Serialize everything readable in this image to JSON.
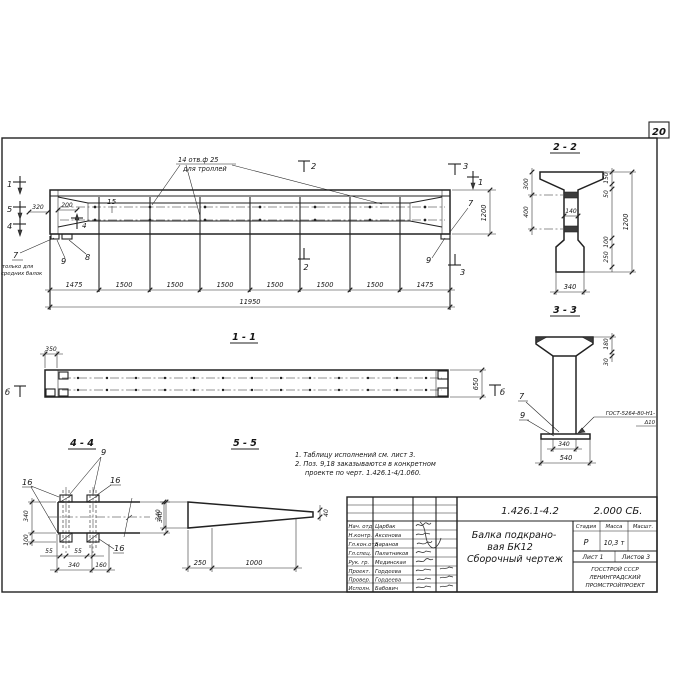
{
  "sheet": {
    "number": "20"
  },
  "elevation": {
    "hole_note_line1": "14 отв.ф 25",
    "hole_note_line2": "для троллей",
    "only_note_line1": "только для",
    "only_note_line2": "средних балок",
    "pos7": "7",
    "pos8": "8",
    "pos9": "9",
    "pos15": "15",
    "pos7_right": "7",
    "pos9_right": "9",
    "cut1_left": "1",
    "cut5_left": "5",
    "cut4_left": "4",
    "cut4_bottom": "4",
    "cut2_top": "2",
    "cut2_bottom": "2",
    "cut3_top": "3",
    "cut3_bottom": "3",
    "cut1_right": "1",
    "dim320": "320",
    "dim200": "200",
    "dim1200": "1200",
    "segments": [
      "1475",
      "1500",
      "1500",
      "1500",
      "1500",
      "1500",
      "1500",
      "1475"
    ],
    "total": "11950"
  },
  "section22": {
    "title": "2 - 2",
    "dim300": "300",
    "dim400": "400",
    "dim140": "140",
    "dim150": "150",
    "dim50": "50",
    "dim1200": "1200",
    "dim100": "100",
    "dim250": "250",
    "dim340": "340"
  },
  "section33": {
    "title": "3 - 3",
    "dim180": "180",
    "dim30": "30",
    "dim340": "340",
    "dim540": "540",
    "pos7": "7",
    "pos9": "9",
    "weld_line1": "ГОСТ-5264-80-Н1-",
    "weld_line2": "Δ10"
  },
  "section11": {
    "title": "1 - 1",
    "dim350": "350",
    "dim650": "650",
    "mark_left": "б",
    "mark_right": "б"
  },
  "section44": {
    "title": "4 - 4",
    "pos9": "9",
    "pos16_left": "16",
    "pos16_right": "16",
    "pos16_bottom": "16",
    "dim340_left": "340",
    "dim100": "100",
    "dim340_right": "340",
    "dim55_a": "55",
    "dim55_b": "55",
    "dim340_bottom": "340",
    "dim160": "160"
  },
  "section55": {
    "title": "5 - 5",
    "dim340": "340",
    "dim40": "40",
    "dim250": "250",
    "dim1000": "1000"
  },
  "notes": {
    "line1": "1. Таблицу исполнений  см. лист 3.",
    "line2": "2. Поз. 9,18 заказываются в конкретном",
    "line3": "проекте по черт. 1.426.1-4/1.060."
  },
  "titleblock": {
    "doc_number": "1.426.1-4.2",
    "doc_code": "2.000 СБ.",
    "title_line1": "Балка подкрано-",
    "title_line2": "вая БК12",
    "title_line3": "Сборочный чертеж",
    "col_stage": "Стадия",
    "col_mass": "Масса",
    "col_scale": "Масшт.",
    "stage": "Р",
    "mass": "10,3 т",
    "sheet_info": "Лист 1",
    "sheets_info": "Листов 3",
    "org_line1": "ГОССТРОЙ СССР",
    "org_line2": "ЛЕНИНГРАДСКИЙ",
    "org_line3": "ПРОМСТРОЙПРОЕКТ",
    "rows": [
      {
        "role": "Нач. отд",
        "name": "Царбак"
      },
      {
        "role": "Н.контр.",
        "name": "Аксенова"
      },
      {
        "role": "Гл.кон.отд",
        "name": "Баранов"
      },
      {
        "role": "Гл.спец.",
        "name": "Палатников"
      },
      {
        "role": "Рук. гр.",
        "name": "Мединская"
      },
      {
        "role": "Проект.",
        "name": "Гордеева"
      },
      {
        "role": "Провер.",
        "name": "Гордеева"
      },
      {
        "role": "Исполн.",
        "name": "Бабович"
      }
    ]
  }
}
